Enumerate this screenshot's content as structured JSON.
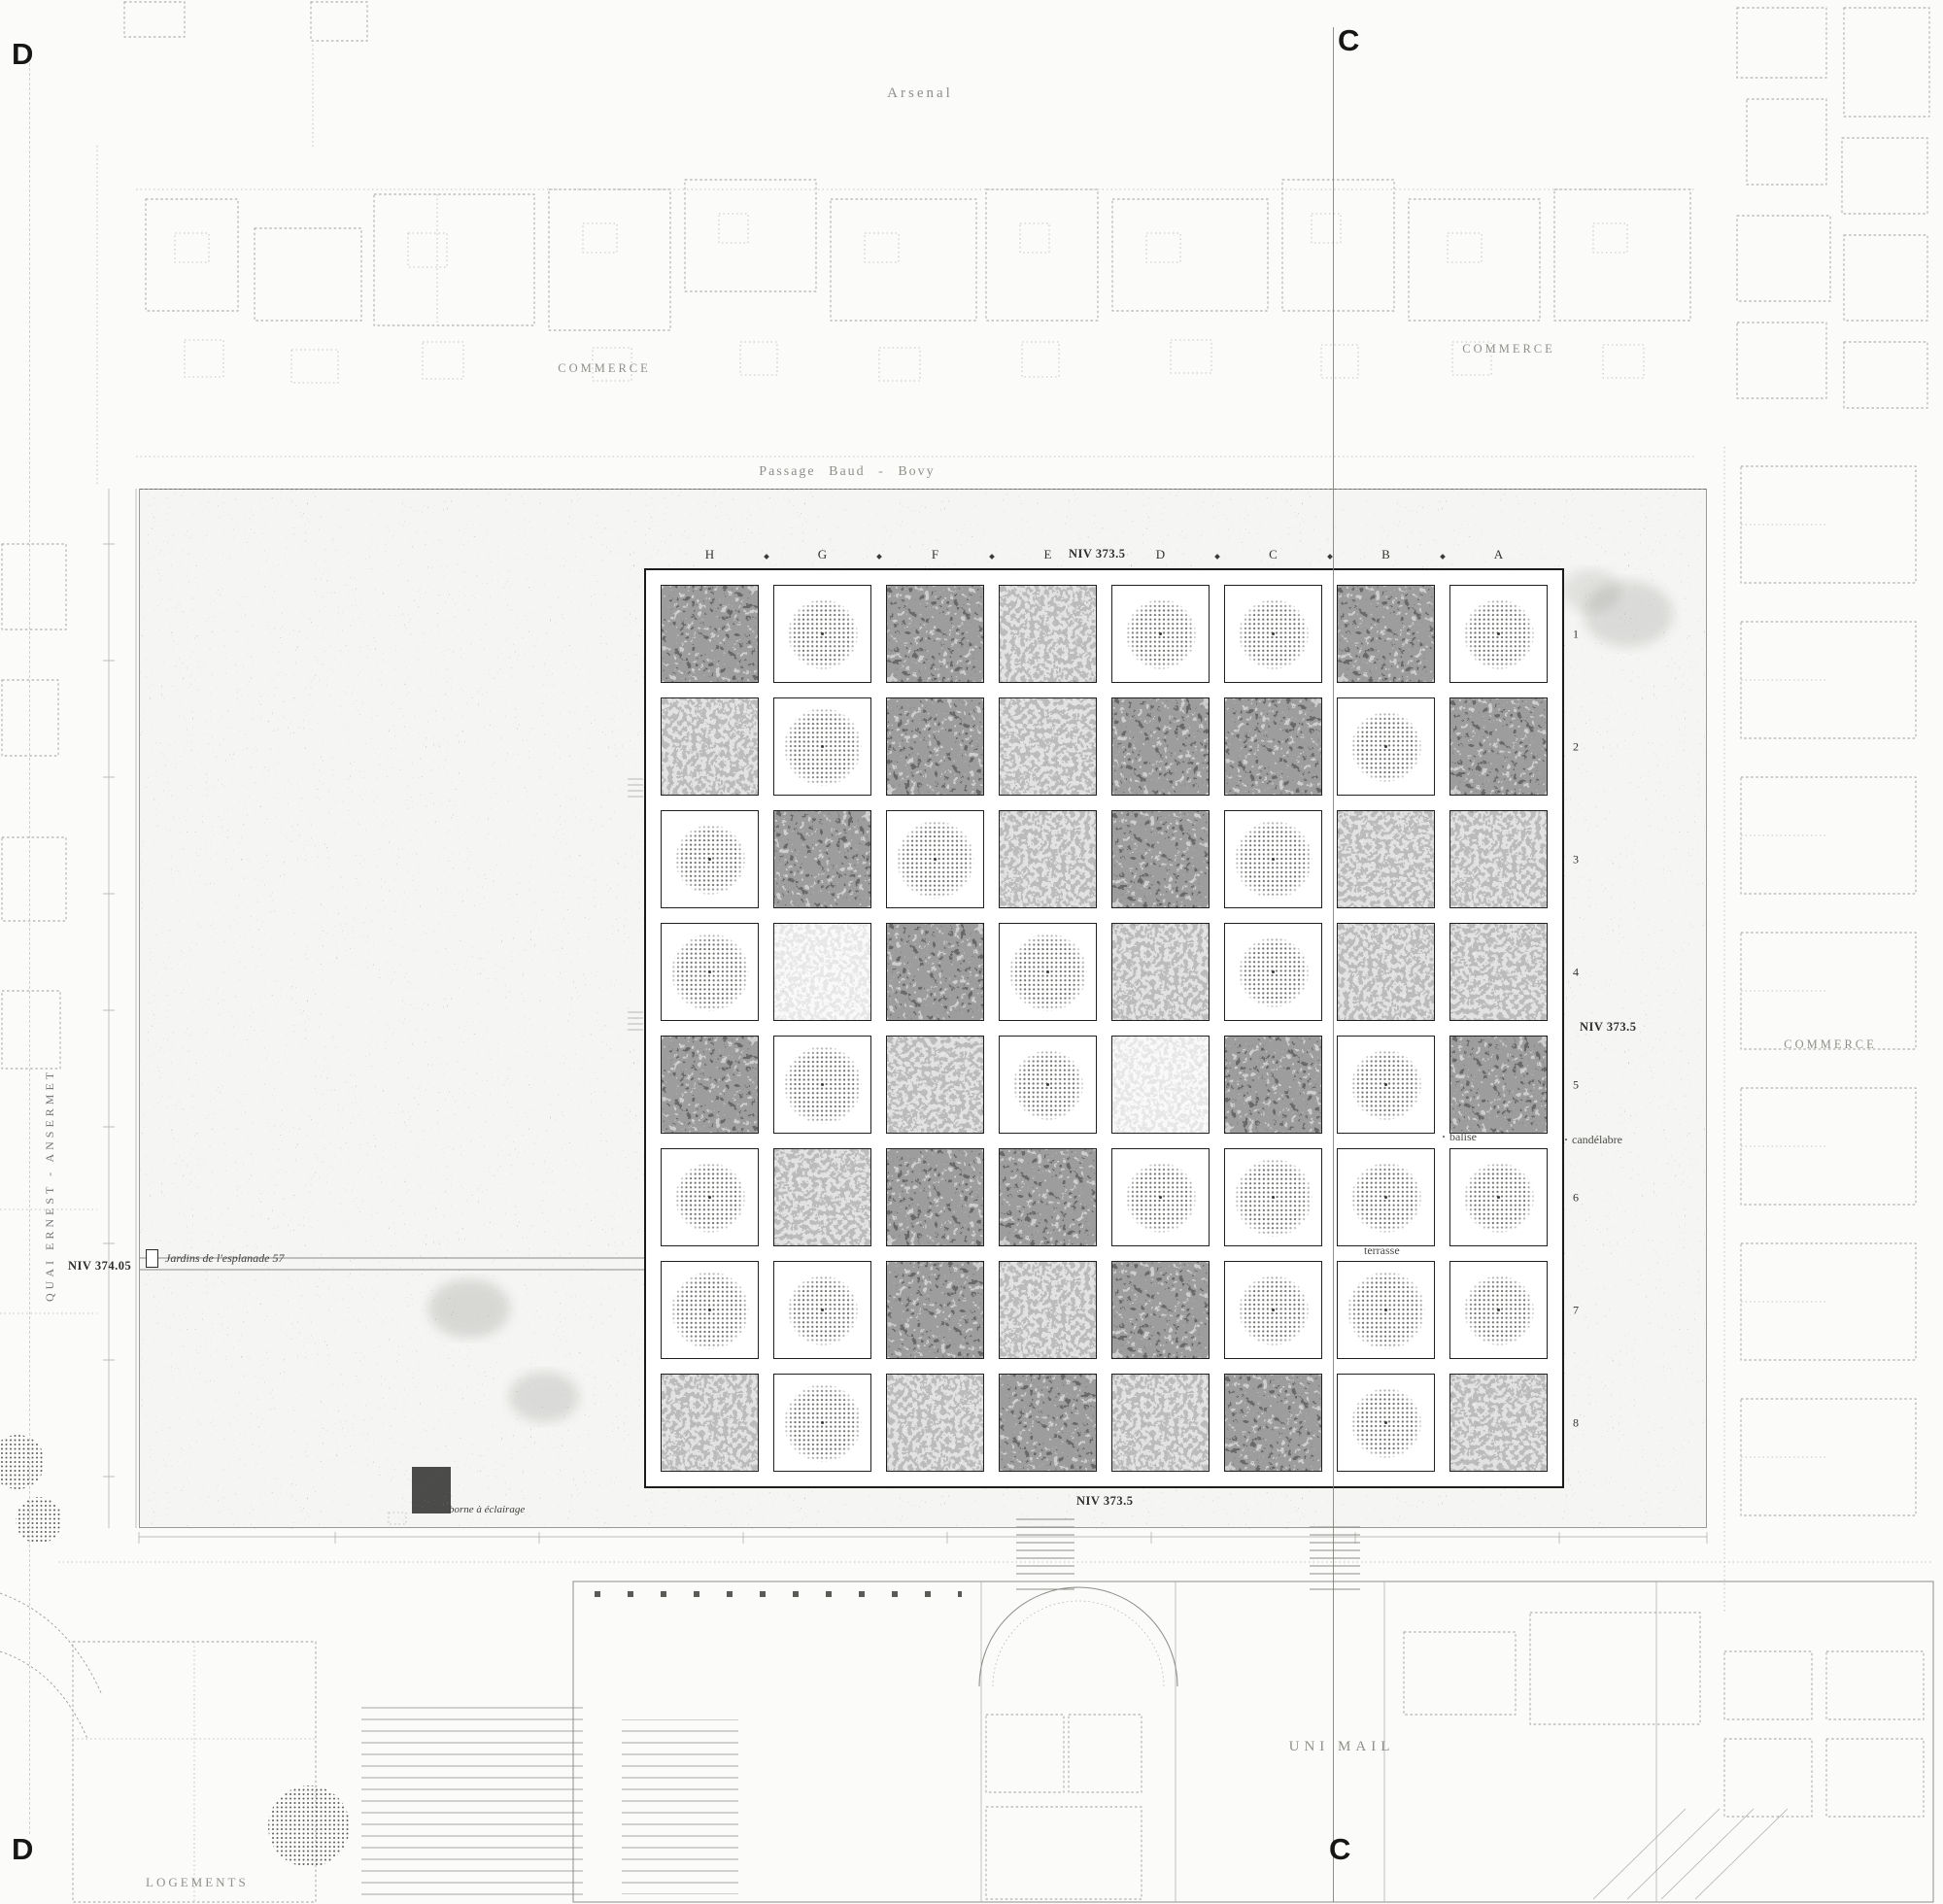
{
  "drawing": {
    "section_markers": {
      "d": "D",
      "c": "C"
    },
    "labels": {
      "arsenal": "Arsenal",
      "passage": "Passage  Baud - Bovy",
      "commerce_top_left": "COMMERCE",
      "commerce_top_right": "COMMERCE",
      "commerce_right": "COMMERCE",
      "quai": "QUAI ERNEST - ANSERMET",
      "niv_374_05": "NIV 374.05",
      "esplanade_note": "Jardins de l'esplanade 57",
      "niv_373_5_top": "NIV 373.5",
      "niv_373_5_right": "NIV 373.5",
      "niv_373_5_bottom": "NIV 373.5",
      "balise": "balise",
      "candelabre": "candélabre",
      "terrasse": "terrasse",
      "borne": "borne à éclairage",
      "uni_mail": "UNI  MAIL",
      "logements": "LOGEMENTS"
    },
    "grid": {
      "column_letters": [
        "H",
        "G",
        "F",
        "E",
        "D",
        "C",
        "B",
        "A"
      ],
      "row_numbers": [
        "1",
        "2",
        "3",
        "4",
        "5",
        "6",
        "7",
        "8"
      ],
      "cell_legend": {
        "t": "tree-canopy-symbol",
        "d": "photo-dark",
        "m": "photo-medium",
        "l": "photo-light"
      },
      "rows": [
        [
          "d",
          "t",
          "d",
          "m",
          "t",
          "t",
          "d",
          "t"
        ],
        [
          "m",
          "t",
          "d",
          "m",
          "d",
          "d",
          "t",
          "d"
        ],
        [
          "t",
          "d",
          "t",
          "m",
          "d",
          "t",
          "m",
          "m"
        ],
        [
          "t",
          "l",
          "d",
          "t",
          "m",
          "t",
          "m",
          "m"
        ],
        [
          "d",
          "t",
          "m",
          "t",
          "l",
          "d",
          "t",
          "d"
        ],
        [
          "t",
          "m",
          "d",
          "d",
          "t",
          "t",
          "t",
          "t"
        ],
        [
          "t",
          "t",
          "d",
          "m",
          "d",
          "t",
          "t",
          "t"
        ],
        [
          "m",
          "t",
          "m",
          "d",
          "m",
          "d",
          "t",
          "m"
        ]
      ]
    },
    "colors": {
      "paper": "#fbfbf9",
      "ink": "#1b1b1b",
      "faint_line": "#9d9d9a",
      "stipple": "#474744"
    }
  }
}
